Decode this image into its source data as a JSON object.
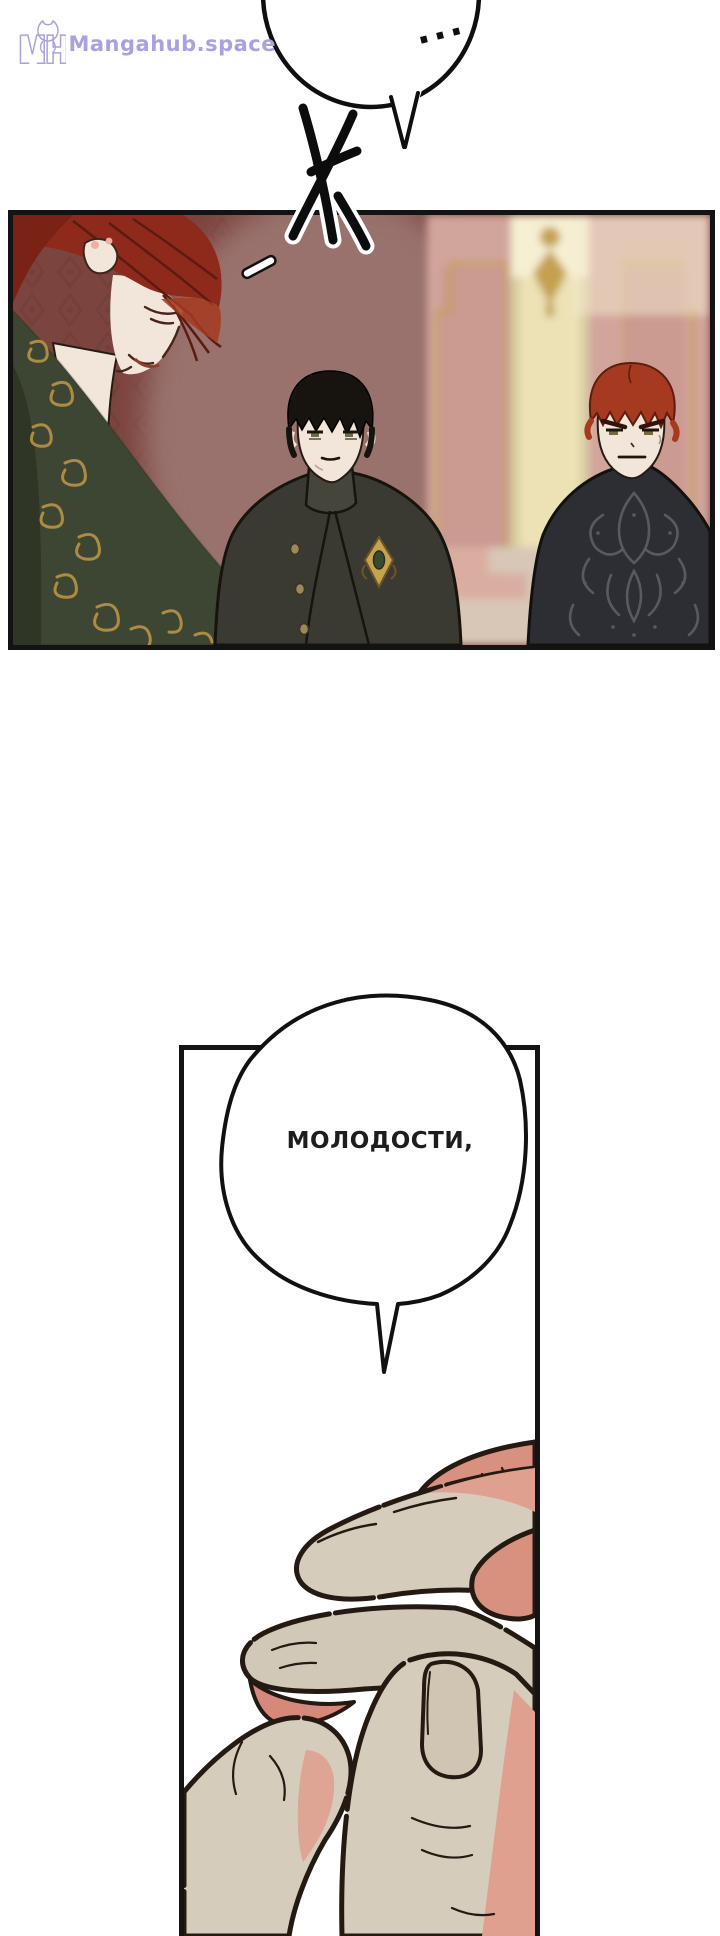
{
  "watermark": {
    "monogram": "MH",
    "site_name": "Mangahub.space",
    "color": "#a9a2dc"
  },
  "bubbles": {
    "top": {
      "text": "..."
    },
    "middle": {
      "text": "МОЛОДОСТИ,"
    }
  },
  "sfx": {
    "name": "brush-stroke-sfx"
  },
  "panels": {
    "panel1": {
      "alt": "Three men in formal court dress standing in a palace hall"
    },
    "panel2": {
      "alt": "Close-up of a hand with curled fingers"
    }
  },
  "palette": {
    "wall_maroon": "#7c443e",
    "wall_maroon_pattern": "#6d3a34",
    "wall_mauve": "#9b7470",
    "wall_pink": "#d2a59c",
    "frame_gold": "#c4a050",
    "pillar_cream": "#ece2b6",
    "baseboard_cream": "#d8c7b6",
    "robe_green": "#3d4633",
    "robe_green_dark": "#2f3626",
    "robe_gold": "#ad8c42",
    "hair_red_dark": "#8e2a1b",
    "hair_red_bright": "#a53a20",
    "hair_black": "#17140f",
    "skin": "#f2e5da",
    "coat_charcoal": "#3a3a33",
    "coat_black": "#2c2e33",
    "coat_pattern": "#565a63",
    "brooch_gold": "#c8a34e",
    "brooch_gem": "#3a4a2e",
    "hand_base": "#d6ccbc",
    "hand_base2": "#d2c8b8",
    "hand_pink": "#dfa08f",
    "hand_pink_deep": "#d8907f",
    "nail": "#d0c5b3",
    "outline": "#241a12"
  }
}
